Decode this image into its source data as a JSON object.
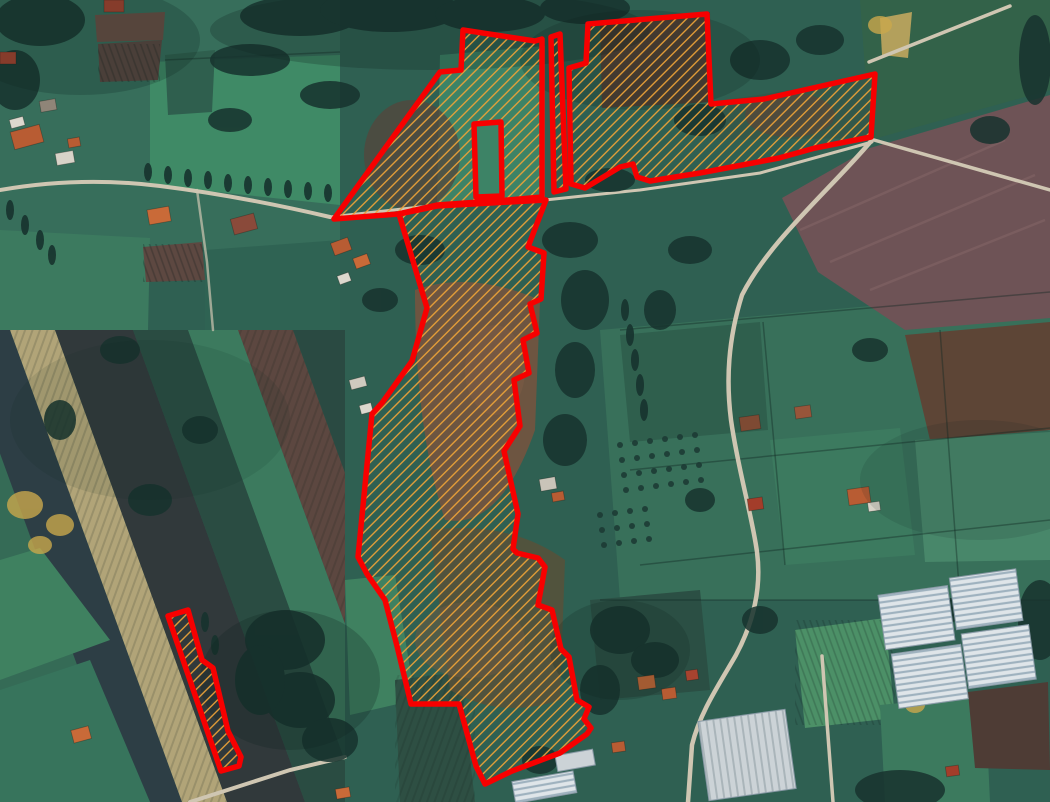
{
  "view": {
    "kind": "satellite-map-with-parcel-overlay",
    "width_px": 1050,
    "height_px": 802
  },
  "overlay": {
    "outline_color": "#f70000",
    "outline_width": 5.5,
    "hatch": {
      "color": "#eda338",
      "spacing": 7.5,
      "line_width": 1.3,
      "angle_deg": -45,
      "direction": "bottom-left-to-top-right"
    },
    "parcels": [
      {
        "id": "northwest",
        "points": [
          [
            463,
            30
          ],
          [
            535,
            41
          ],
          [
            542,
            39
          ],
          [
            542,
            197
          ],
          [
            508,
            200
          ],
          [
            437,
            205
          ],
          [
            398,
            214
          ],
          [
            334,
            219
          ],
          [
            440,
            72
          ],
          [
            461,
            70
          ]
        ],
        "holes": [
          [
            [
              474,
              124
            ],
            [
              501,
              122
            ],
            [
              502,
              196
            ],
            [
              476,
              197
            ]
          ]
        ]
      },
      {
        "id": "north-sliver",
        "points": [
          [
            551,
            37
          ],
          [
            560,
            34
          ],
          [
            566,
            189
          ],
          [
            554,
            192
          ]
        ]
      },
      {
        "id": "northeast",
        "points": [
          [
            588,
            24
          ],
          [
            707,
            14
          ],
          [
            711,
            104
          ],
          [
            764,
            99
          ],
          [
            875,
            74
          ],
          [
            871,
            137
          ],
          [
            815,
            148
          ],
          [
            779,
            158
          ],
          [
            700,
            173
          ],
          [
            650,
            181
          ],
          [
            637,
            177
          ],
          [
            633,
            164
          ],
          [
            620,
            167
          ],
          [
            585,
            188
          ],
          [
            571,
            184
          ],
          [
            569,
            68
          ],
          [
            586,
            63
          ]
        ]
      },
      {
        "id": "central",
        "points": [
          [
            399,
            214
          ],
          [
            437,
            206
          ],
          [
            546,
            200
          ],
          [
            528,
            247
          ],
          [
            544,
            253
          ],
          [
            541,
            299
          ],
          [
            530,
            304
          ],
          [
            537,
            333
          ],
          [
            523,
            340
          ],
          [
            529,
            373
          ],
          [
            514,
            380
          ],
          [
            520,
            426
          ],
          [
            504,
            451
          ],
          [
            518,
            514
          ],
          [
            513,
            549
          ],
          [
            517,
            553
          ],
          [
            538,
            558
          ],
          [
            545,
            567
          ],
          [
            538,
            605
          ],
          [
            552,
            610
          ],
          [
            561,
            649
          ],
          [
            569,
            657
          ],
          [
            577,
            700
          ],
          [
            589,
            707
          ],
          [
            584,
            719
          ],
          [
            591,
            728
          ],
          [
            587,
            734
          ],
          [
            560,
            753
          ],
          [
            512,
            771
          ],
          [
            485,
            784
          ],
          [
            476,
            766
          ],
          [
            459,
            704
          ],
          [
            411,
            704
          ],
          [
            397,
            646
          ],
          [
            385,
            600
          ],
          [
            367,
            574
          ],
          [
            358,
            557
          ],
          [
            372,
            414
          ],
          [
            382,
            403
          ],
          [
            412,
            361
          ],
          [
            427,
            308
          ]
        ]
      },
      {
        "id": "south-strip",
        "points": [
          [
            168,
            616
          ],
          [
            188,
            610
          ],
          [
            202,
            660
          ],
          [
            213,
            668
          ],
          [
            228,
            731
          ],
          [
            241,
            757
          ],
          [
            239,
            766
          ],
          [
            221,
            771
          ]
        ]
      }
    ]
  },
  "background": {
    "palette": {
      "base_green": "#2f6052",
      "bright_green": "#3f8160",
      "dark_teal": "#24443e",
      "tan_field": "#b1a478",
      "brown_field": "#5c4740",
      "plowed_purple_brown": "#6e5356",
      "dark_plowed": "#31393b",
      "road": "#cfc6b2",
      "greenhouse_light": "#dfe5e9",
      "greenhouse_shade": "#9fb2bf",
      "roof_orange": "#b85c33",
      "roof_red": "#a33d2a",
      "tree_dark": "#17332e"
    },
    "features": [
      "farm-fields",
      "village-houses-northwest",
      "houses-center",
      "houses-east",
      "houses-south",
      "winding-road-east",
      "road-northwest",
      "greenhouses-southeast",
      "warehouse-south",
      "tree-lines",
      "orchard-rows",
      "plowed-fields"
    ]
  }
}
